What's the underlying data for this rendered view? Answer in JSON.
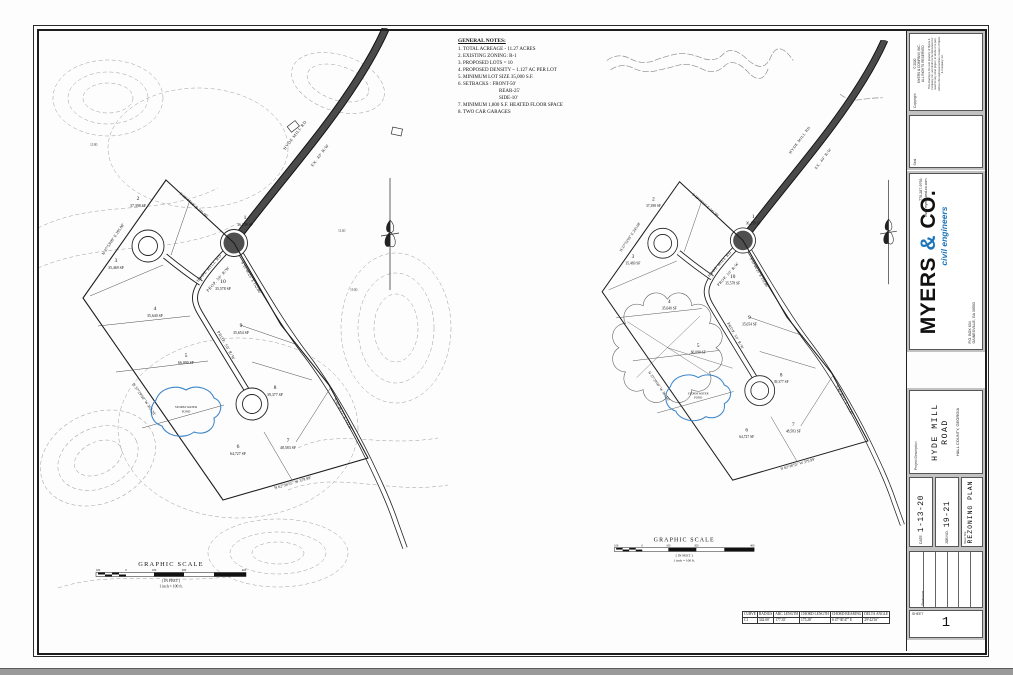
{
  "general_notes": {
    "title": "GENERAL NOTES:",
    "lines": [
      "1.  TOTAL ACREAGE - 11.27 ACRES",
      "2.  EXISTING ZONING:  R-1",
      "3.  PROPOSED LOTS = 10",
      "4.  PROPOSED DENSITY ~ 1.127 AC PER LOT",
      "5.  MINIMUM LOT SIZE 35,000 S.F.",
      "6.  SETBACKS :      FRONT-50'",
      "REAR-25'",
      "SIDE-10'",
      "7.  MINIMUM 1,800 S.F. HEATED FLOOR SPACE",
      "8.  TWO CAR GARAGES"
    ]
  },
  "plan": {
    "lots": [
      {
        "num": "1",
        "area": "36,139 SF"
      },
      {
        "num": "2",
        "area": "37,398 SF"
      },
      {
        "num": "3",
        "area": "35,469 SF"
      },
      {
        "num": "4",
        "area": "35,640 SF"
      },
      {
        "num": "5",
        "area": "66,090 SF"
      },
      {
        "num": "6",
        "area": "64,727 SF"
      },
      {
        "num": "7",
        "area": "48,583 SF"
      },
      {
        "num": "8",
        "area": "39,377 SF"
      },
      {
        "num": "9",
        "area": "35,654 SF"
      },
      {
        "num": "10",
        "area": "35,578 SF"
      }
    ],
    "road_name": "HYDE MILL RD",
    "prop_rw": "PROP. 50' R/W",
    "ex_rw": "EX. 40' R/W",
    "pond_label1": "STORM WATER",
    "pond_label2": "POND",
    "bearings": {
      "b1": "S 58°44'18\" E  241.90'",
      "b2": "S 53°46'25\" E  152.86'",
      "b3": "N 37°53'09\" E  295.08'",
      "b4": "N 37°29'00\" W  362.20'",
      "b5": "N 62°36'55\" W  379.99'",
      "b6": "S 40°46'11\" E  132.87'"
    },
    "scale": {
      "title": "GRAPHIC SCALE",
      "ticks": [
        "100",
        "0",
        "100",
        "200",
        "400"
      ],
      "in_feet": "( IN FEET )",
      "ratio": "1 inch = 100 ft."
    },
    "contour_labels": [
      "1140",
      "1160",
      "1180"
    ]
  },
  "curve_table": {
    "headers": [
      "CURVE",
      "RADIUS",
      "ARC LENGTH",
      "CHORD LENGTH",
      "CHORD BEARING",
      "DELTA ANGLE"
    ],
    "row": [
      "C1",
      "342.00'",
      "177.35'",
      "175.28'",
      "S 47°30'47\" E",
      "29°42'16\""
    ]
  },
  "title_block": {
    "copyright": {
      "label": "Copyright",
      "line1": "© 2020",
      "line2": "MYERS & COMPANY, INC.",
      "line3": "ALL RIGHTS RESERVED",
      "fine_print": "This drawing is the sole property of Myers & Company, Inc. and shall not be reproduced or used for any other project, in whole or in part, without the expressed written consent of Myers & Company, Inc."
    },
    "seal_label": "Seal",
    "logo": {
      "name_myers": "MYERS ",
      "amp": "&",
      "name_co": " CO.",
      "tagline": "civil engineers",
      "addr1": "P.O. BOX 634",
      "addr2": "GAINESVILLE, GA 30503",
      "phone": "770-287-9793",
      "web": "www.myers-and-co.com"
    },
    "project": {
      "label": "Project Description",
      "title": "HYDE MILL ROAD",
      "subtitle": "HALL COUNTY, GEORGIA"
    },
    "date": {
      "label": "DATE",
      "value": "1-13-20"
    },
    "job": {
      "label": "JOB NO.",
      "value": "19-21"
    },
    "sheet_title": {
      "label": "Sheet Title",
      "value": "REZONING PLAN"
    },
    "revisions_label": "Revisions",
    "sheet": {
      "label": "SHEET",
      "value": "1"
    }
  }
}
